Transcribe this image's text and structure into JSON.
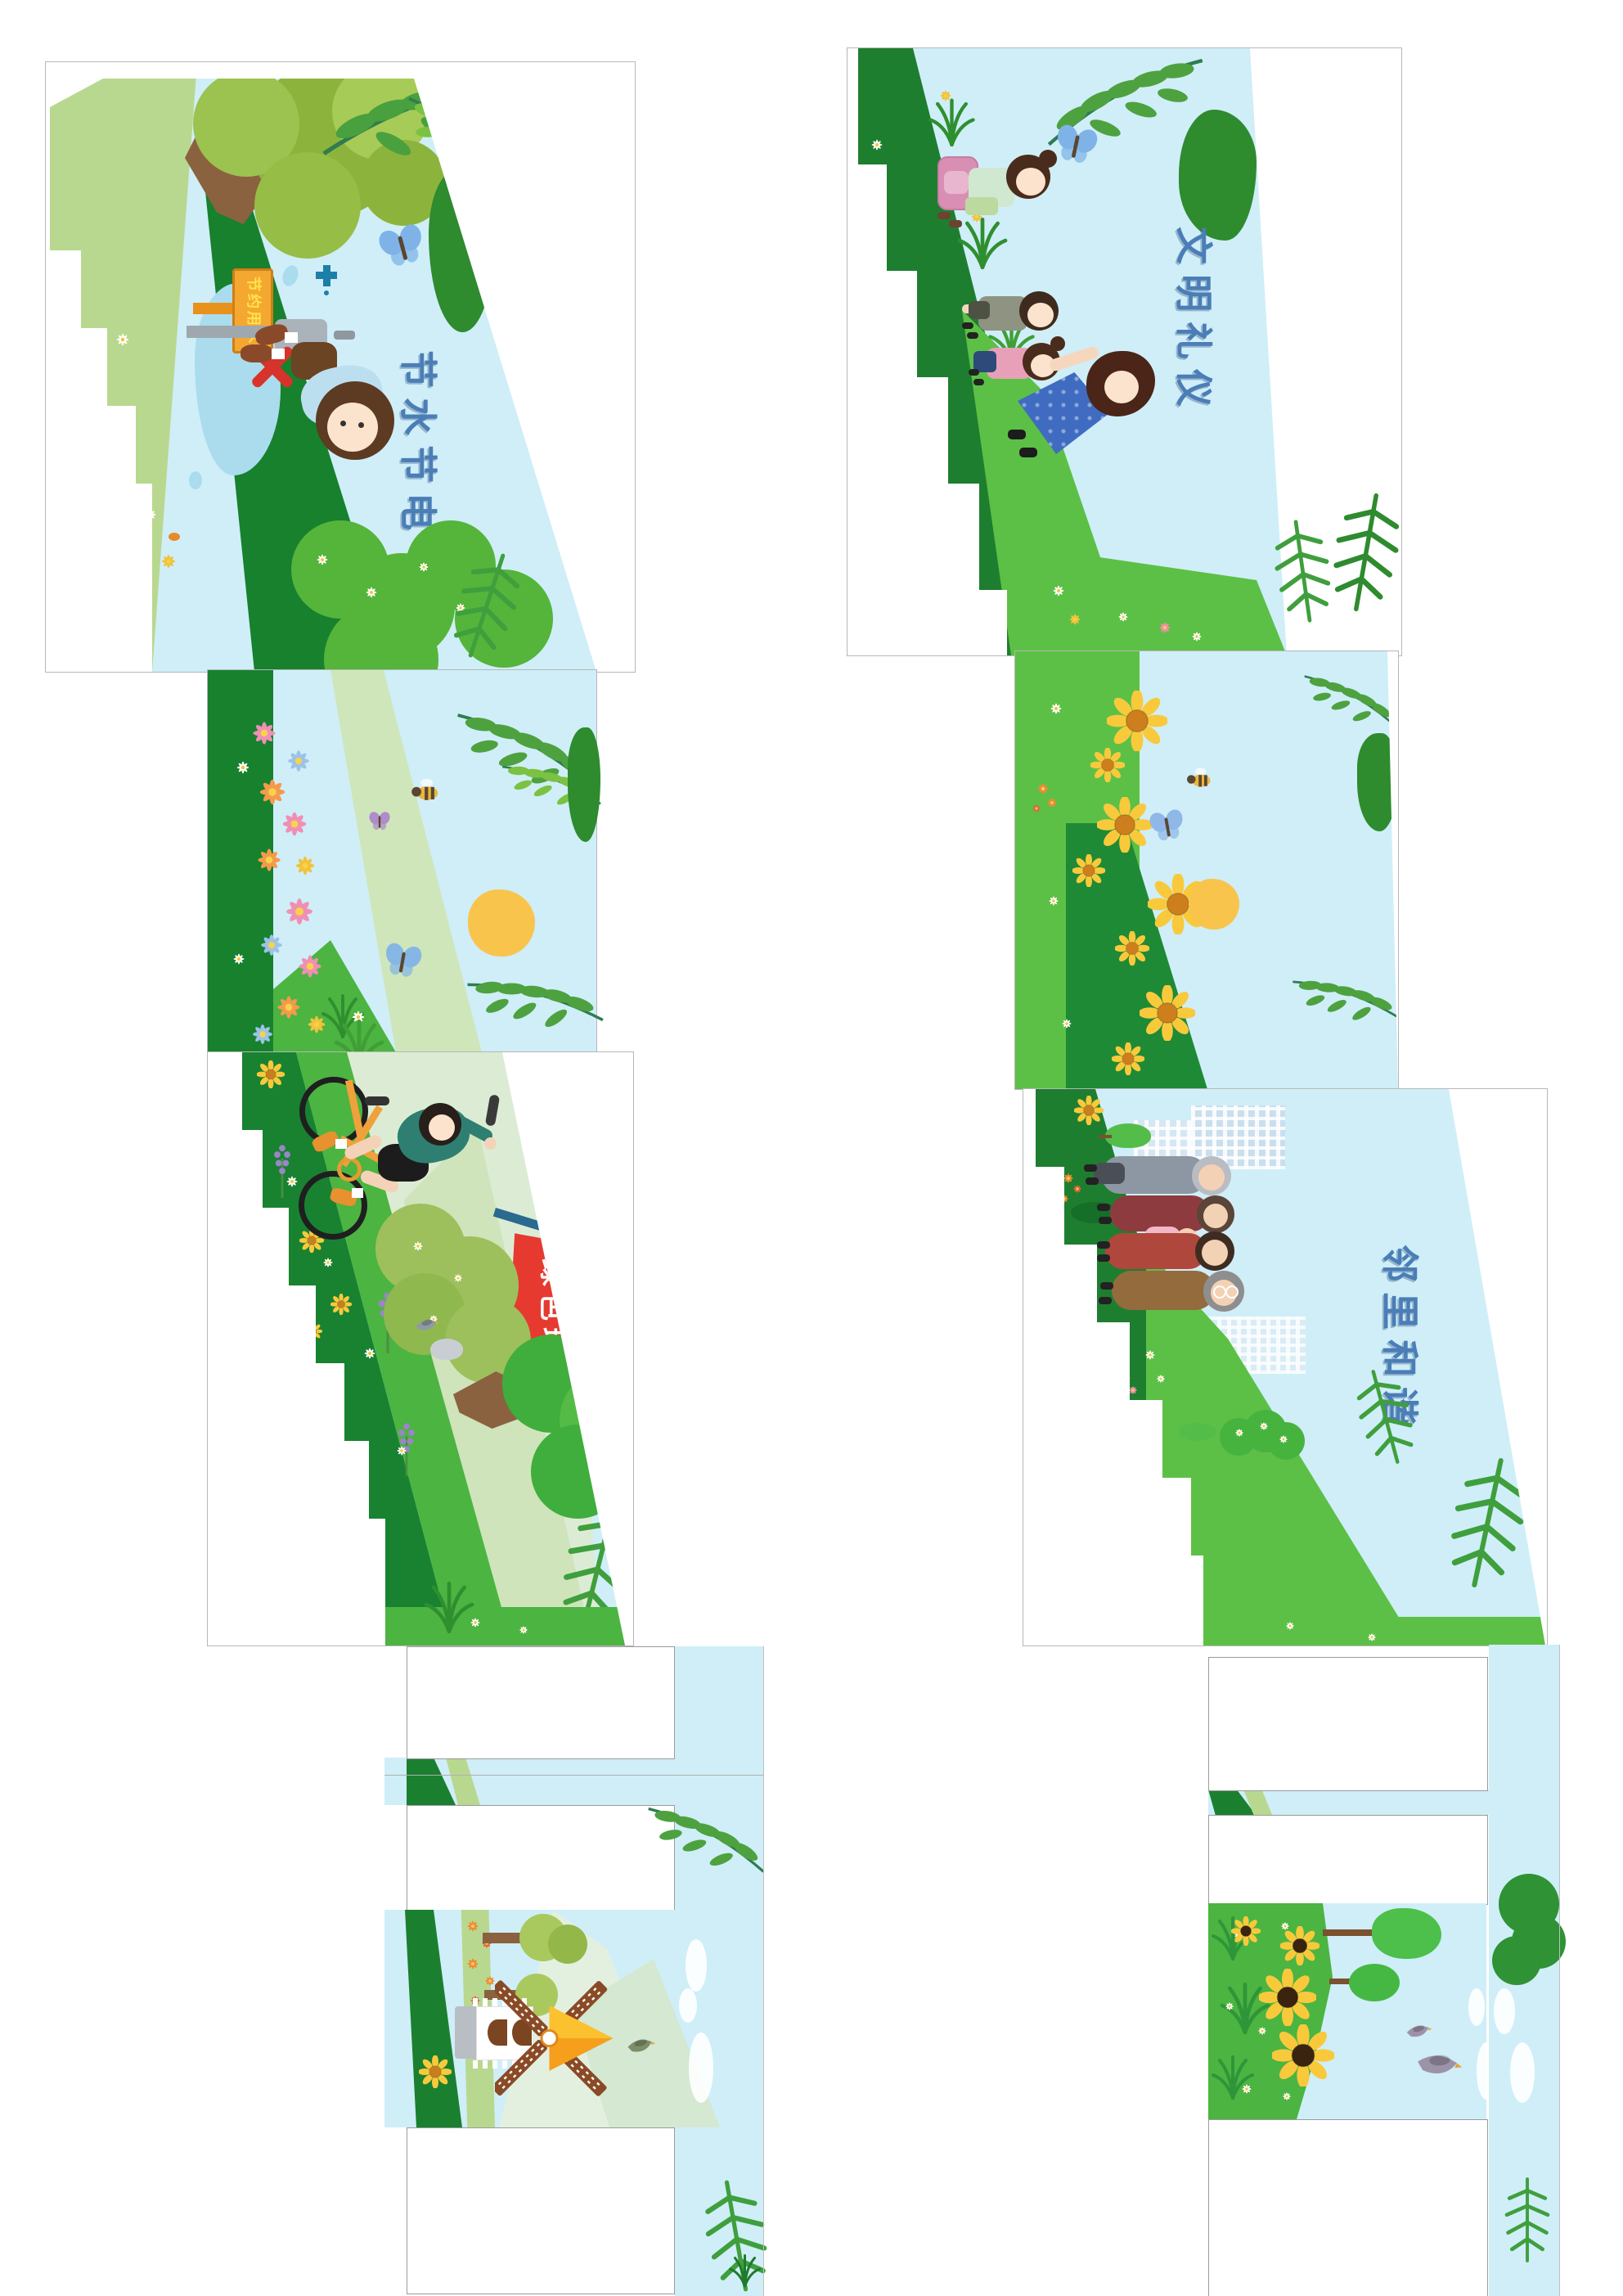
{
  "document": {
    "kind": "stair-riser sticker die-cut design sheet",
    "background": "#ffffff",
    "language": "zh-CN",
    "columns": 2
  },
  "colors": {
    "sky": "#cfeef8",
    "grass_bright": "#4cb441",
    "grass_mid": "#5cc046",
    "grass_dark": "#17812e",
    "grass_light": "#b9d88f",
    "hill_pale": "#d3e6bf",
    "sun": "#f9c44c",
    "flag_red": "#e63a30",
    "flag_pole": "#2a6a8e",
    "sign_orange": "#f5a831",
    "title_blue": "#4b7db6",
    "sign_text_yellow": "#ffe34d",
    "trunk_brown": "#8a6240"
  },
  "panels": {
    "save_water": {
      "title": "节水节电",
      "sign_text": "节约用水"
    },
    "green_env": {
      "flag_text": "绿色环保"
    },
    "civility": {
      "title": "文明礼仪"
    },
    "harmony": {
      "title": "邻里和谐"
    }
  },
  "figures": [
    "boy-at-tap",
    "cyclist",
    "girl-with-backpack",
    "boy-walking",
    "girl-walking",
    "mother",
    "elderly-group"
  ],
  "decorations": [
    "tree",
    "willow-branch",
    "oak-leaf",
    "butterfly",
    "bee",
    "bird",
    "sun",
    "sunflower",
    "daisy",
    "lavender",
    "tulip",
    "fern",
    "cloud",
    "windmill",
    "house",
    "wind-turbine",
    "city-buildings",
    "bicycle",
    "red-flag",
    "water-tap",
    "water-splash",
    "no-waste-cross"
  ],
  "placeholders": {
    "white_label_boxes": 6
  }
}
